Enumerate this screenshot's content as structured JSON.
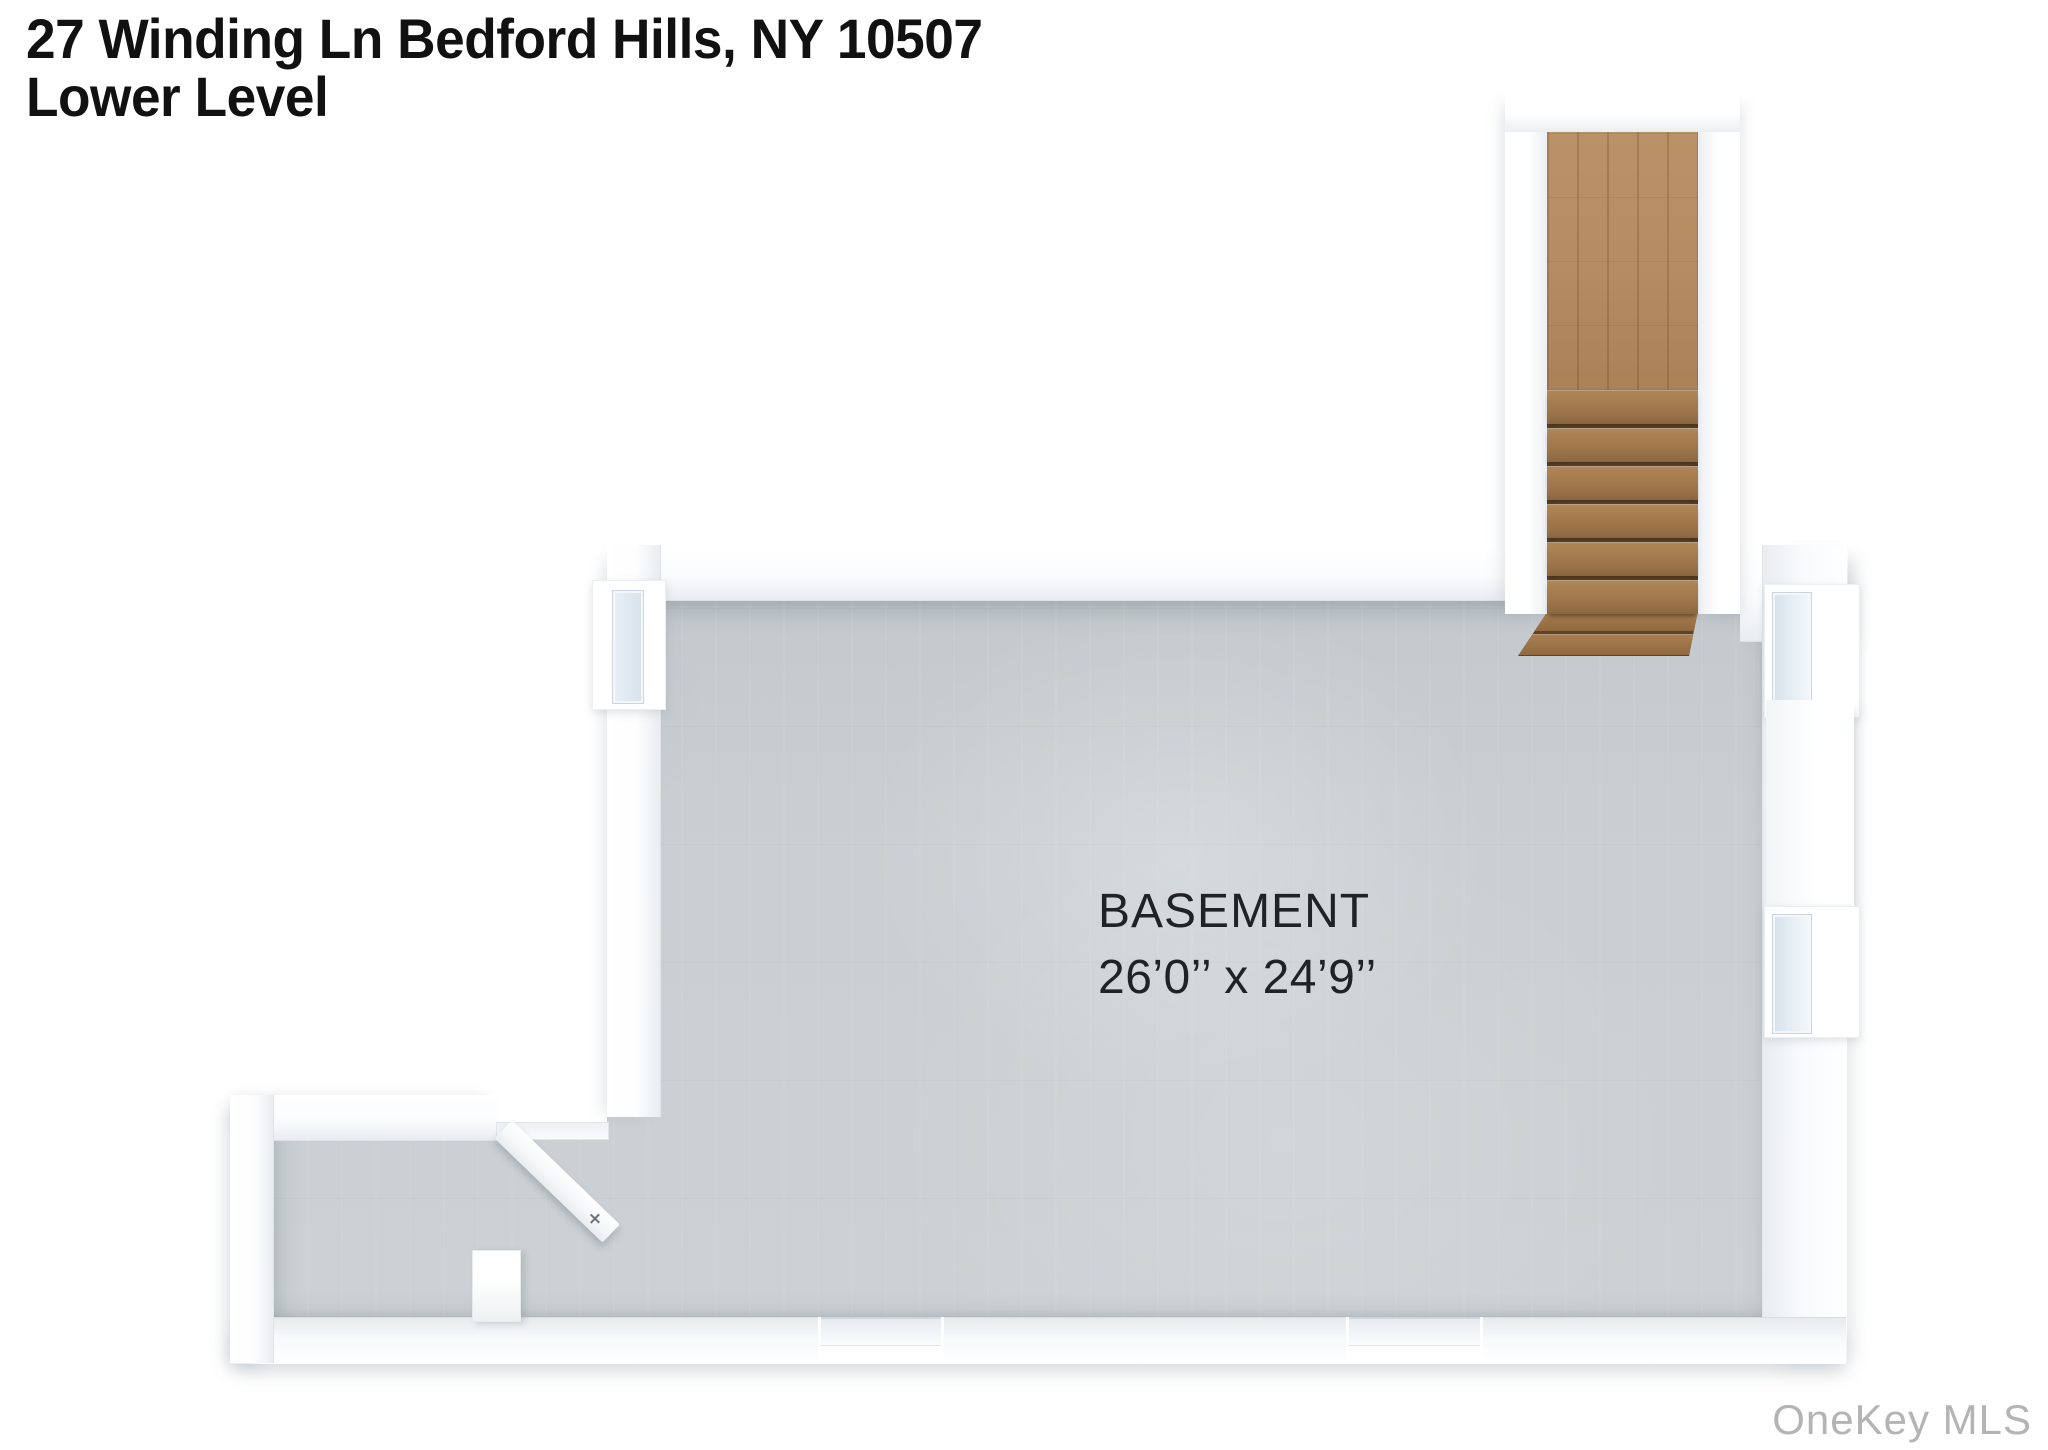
{
  "image": {
    "type": "3d-floor-plan-rendering",
    "view": "top-down"
  },
  "title": {
    "line1": "27 Winding Ln Bedford Hills, NY 10507",
    "line2": "Lower Level"
  },
  "room": {
    "name": "BASEMENT",
    "dimensions": "26’0’’ x 24’9’’"
  },
  "watermark": {
    "text": "OneKey MLS",
    "color": "#b4b4b4"
  },
  "features": {
    "stair_steps_visible": 8,
    "stair_has_landing": true,
    "right_wall_windows": 2,
    "left_wall_windows": 1,
    "bottom_wall_openings": 2,
    "open_door_leaves": 1
  },
  "colors": {
    "background": "#ffffff",
    "floor": "#c9cfd2",
    "wall_face": "#f4f6f8",
    "wall_top": "#ffffff",
    "stair_landing_wood": "#b58c62",
    "stair_step_wood": "#9a7349",
    "stair_gap_shadow": "#5f4329",
    "window_glass": "#dde7f0",
    "title_text": "#111111",
    "label_text": "#1f2326"
  },
  "icons": [
    {
      "name": "door-handle-icon",
      "meaning": "handle on open door leaf",
      "shape": "small cross"
    }
  ]
}
